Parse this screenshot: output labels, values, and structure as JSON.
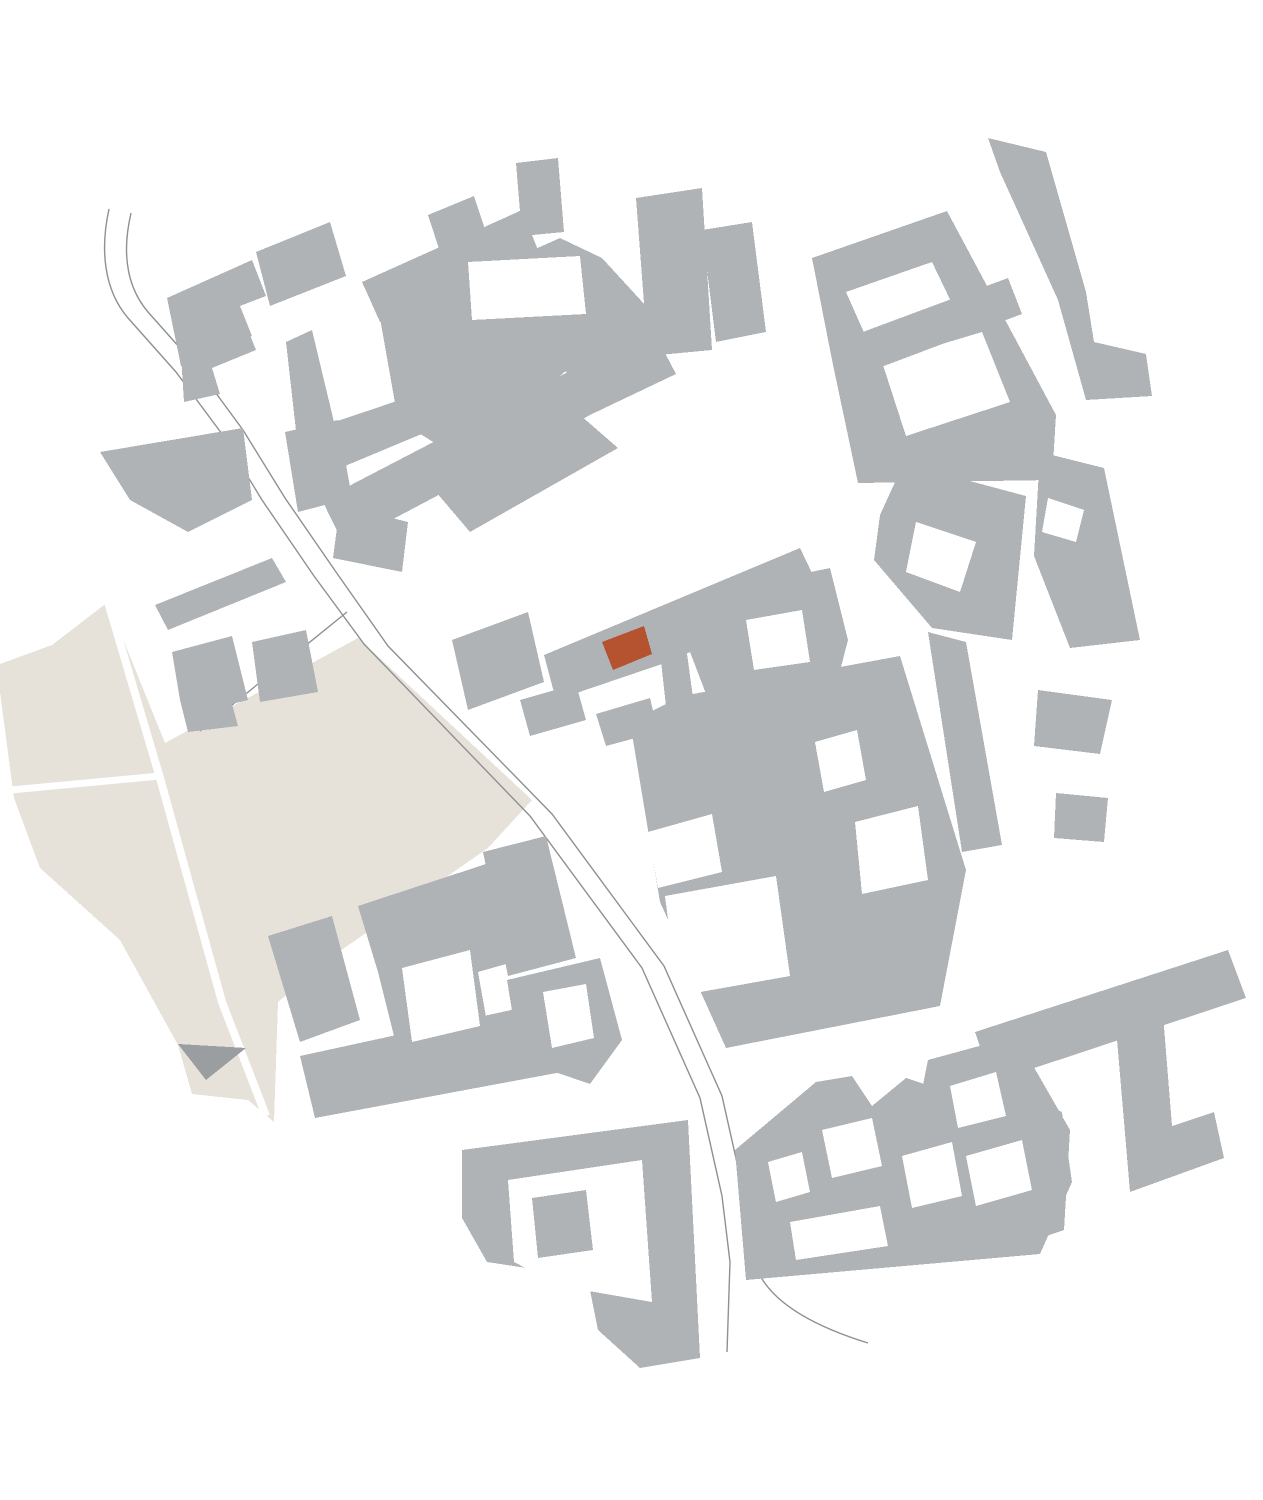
{
  "title": "Figure-ground site plan with highlighted building",
  "colors": {
    "background": "#ffffff",
    "building": "#b0b3b5",
    "courtyard": "#ffffff",
    "site": "#e6e2da",
    "site_path": "#ffffff",
    "site_accent": "#9b9ea0",
    "road": "#8e9092",
    "highlight": "#b5522f"
  },
  "map": {
    "canvas": {
      "width": 1263,
      "height": 1500,
      "viewbox": "0 0 1263 1500"
    },
    "site_areas": [
      {
        "name": "park-site",
        "points": "0,664 52,645 108,602 165,743 358,638 532,800 488,848 330,958 278,1002 274,1122 248,1100 192,1094 178,1045 120,940 40,868 14,798 0,692"
      }
    ],
    "site_paths": [
      {
        "name": "site-path",
        "d": "M108,602 L160,778 L222,1002 L266,1116",
        "width": 8
      },
      {
        "name": "site-path",
        "d": "M0,791 L160,776",
        "width": 7
      }
    ],
    "site_accents": [
      {
        "name": "parcel-shadow-triangle",
        "points": "178,1044 246,1048 206,1080"
      }
    ],
    "roads": [
      {
        "name": "road-line-west",
        "d": "M109,209 C100,250 104,290 128,318 L176,372 222,434 262,500 314,576 364,644 530,816 642,968 700,1098 722,1196 730,1262 727,1352"
      },
      {
        "name": "road-line-east",
        "d": "M131,213 C122,252 126,286 148,312 L196,366 243,430 285,498 336,572 388,646 552,814 664,966 722,1096 744,1194 752,1250 C756,1292 800,1322 868,1343"
      },
      {
        "name": "road-branch",
        "d": "M347,612 L200,731"
      }
    ],
    "buildings": [
      {
        "points": "167,298 252,260 266,296 240,306 252,336 181,366"
      },
      {
        "points": "180,340 242,315 256,350 212,368 220,394 184,402"
      },
      {
        "points": "256,252 330,222 346,276 270,306"
      },
      {
        "points": "100,452 243,428 252,500 188,532 130,500"
      },
      {
        "points": "155,605 272,558 286,582 168,630"
      },
      {
        "points": "172,652 232,636 248,700 232,704 238,726 188,732 180,700"
      },
      {
        "points": "252,642 306,630 318,692 260,702"
      },
      {
        "points": "516,163 558,158 564,232 522,236"
      },
      {
        "points": "428,215 474,196 488,238 442,258"
      },
      {
        "points": "362,282 522,210 538,250 380,322"
      },
      {
        "points": "636,198 702,188 712,350 648,356"
      },
      {
        "points": "702,230 752,222 766,332 716,342"
      },
      {
        "points": "380,318 560,238 602,258 646,306 662,356 564,372 478,470 398,420"
      },
      {
        "points": "286,342 312,330 334,422 424,392 436,428 302,484"
      },
      {
        "points": "322,500 568,372 592,414 344,545"
      },
      {
        "points": "566,372 654,332 676,374 592,414"
      },
      {
        "points": "285,432 338,420 352,498 298,512"
      },
      {
        "points": "340,505 408,522 402,572 333,558"
      },
      {
        "points": "436,492 572,408 618,448 470,532"
      },
      {
        "points": "812,258 947,211 1056,415 1052,480 858,483 832,360"
      },
      {
        "points": "988,138 1046,152 1086,292 1094,342 1146,354 1152,396 1086,400 1058,300 1000,172"
      },
      {
        "points": "880,515 906,458 936,472 1026,496 1012,640 932,628 874,560"
      },
      {
        "points": "928,632 966,642 1002,845 962,852"
      },
      {
        "points": "1056,793 1108,798 1104,842 1054,838"
      },
      {
        "points": "1040,452 1104,468 1140,640 1070,648 1034,556"
      },
      {
        "points": "1038,690 1112,700 1100,754 1034,746"
      },
      {
        "points": "452,640 528,612 544,682 468,710"
      },
      {
        "points": "544,655 800,548 824,598 700,648 662,664 556,700"
      },
      {
        "points": "700,595 830,568 848,640 832,702 716,720 690,652"
      },
      {
        "points": "660,652 686,646 696,720 668,724"
      },
      {
        "points": "520,700 576,684 586,720 530,736"
      },
      {
        "points": "596,714 650,698 658,732 606,746"
      },
      {
        "points": "630,722 682,696 900,656 966,870 940,1006 726,1048 660,902"
      },
      {
        "points": "268,936 332,916 360,1020 300,1042"
      },
      {
        "points": "358,906 492,862 520,960 478,972 488,1028 398,1052 378,972"
      },
      {
        "points": "483,852 546,836 576,958 508,976"
      },
      {
        "points": "300,1056 548,1002 562,1072 315,1118"
      },
      {
        "points": "507,980 600,958 622,1040 590,1084 520,1060"
      },
      {
        "points": "462,1150 688,1120 700,1358 640,1368 598,1330 590,1290 540,1270 487,1262 462,1218"
      },
      {
        "points": "735,1150 816,1082 852,1076 872,1106 906,1078 942,1090 946,1120 1036,1098 1062,1112 1072,1182 1040,1254 746,1280"
      },
      {
        "points": "975,1032 1228,950 1246,998 992,1082"
      },
      {
        "points": "1115,1016 1162,1002 1172,1126 1214,1112 1224,1158 1130,1192"
      },
      {
        "points": "928,1060 1016,1036 1070,1130 1064,1230 1006,1250 940,1180 920,1100"
      }
    ],
    "courtyards": [
      {
        "points": "468,262 580,256 586,314 472,320"
      },
      {
        "points": "846,292 932,262 956,312 870,346"
      },
      {
        "points": "882,362 982,332 1010,402 906,436"
      },
      {
        "points": "916,522 976,542 960,592 906,572"
      },
      {
        "points": "1048,498 1084,510 1076,542 1042,532"
      },
      {
        "points": "746,620 802,610 810,662 754,670"
      },
      {
        "points": "648,832 712,814 722,872 658,888"
      },
      {
        "points": "665,896 776,876 790,976 678,996"
      },
      {
        "points": "855,822 918,806 928,880 862,894"
      },
      {
        "points": "815,742 857,730 866,780 824,792"
      },
      {
        "points": "402,968 470,950 480,1026 412,1042"
      },
      {
        "points": "543,992 586,984 594,1038 552,1048"
      },
      {
        "points": "508,1180 642,1160 652,1302 560,1286 514,1262"
      },
      {
        "points": "768,1162 802,1152 810,1192 776,1202"
      },
      {
        "points": "822,1130 872,1118 882,1166 832,1178"
      },
      {
        "points": "902,1156 952,1142 962,1196 912,1208"
      },
      {
        "points": "790,1222 880,1206 888,1246 796,1260"
      },
      {
        "points": "950,1086 996,1072 1006,1116 958,1128"
      },
      {
        "points": "966,1156 1022,1140 1032,1190 976,1206"
      }
    ],
    "inner_wings": [
      {
        "points": "852,336 1008,278 1022,314 868,372"
      },
      {
        "points": "532,1198 586,1190 593,1250 538,1258"
      }
    ],
    "highlight": {
      "name": "highlighted-building",
      "points": "602,642 644,626 652,654 613,670"
    }
  }
}
